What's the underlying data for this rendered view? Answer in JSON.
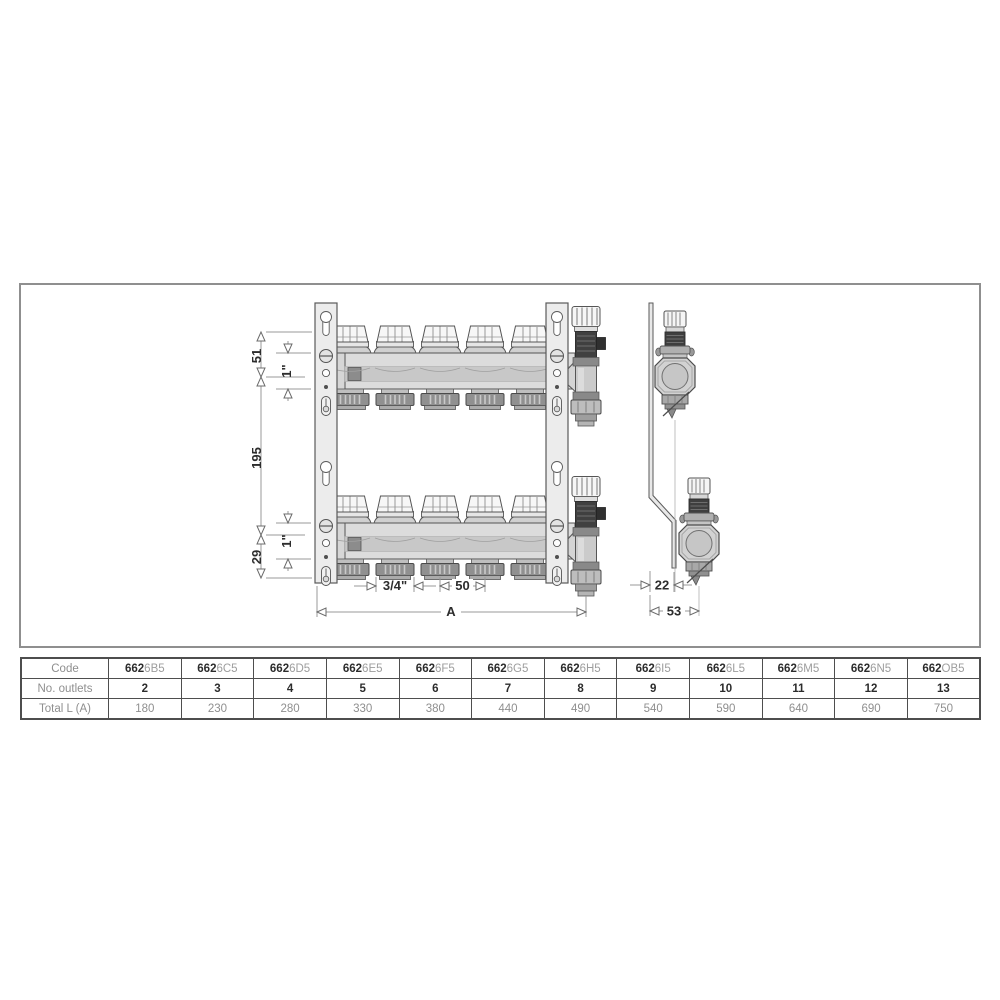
{
  "drawing": {
    "front": {
      "dim_top_offset": "51",
      "dim_pipe_top": "1\"",
      "dim_axis_distance": "195",
      "dim_bottom_offset": "29",
      "dim_pipe_bottom": "1\"",
      "dim_outlet_size": "3/4\"",
      "dim_outlet_spacing": "50",
      "dim_total_length": "A"
    },
    "side": {
      "dim_bracket_offset": "22",
      "dim_overall_depth": "53"
    }
  },
  "table": {
    "row_labels": {
      "code": "Code",
      "outlets": "No. outlets",
      "total": "Total L (A)"
    },
    "code_prefix": "662",
    "columns": [
      {
        "code_suffix": "6B5",
        "outlets": "2",
        "total": "180"
      },
      {
        "code_suffix": "6C5",
        "outlets": "3",
        "total": "230"
      },
      {
        "code_suffix": "6D5",
        "outlets": "4",
        "total": "280"
      },
      {
        "code_suffix": "6E5",
        "outlets": "5",
        "total": "330"
      },
      {
        "code_suffix": "6F5",
        "outlets": "6",
        "total": "380"
      },
      {
        "code_suffix": "6G5",
        "outlets": "7",
        "total": "440"
      },
      {
        "code_suffix": "6H5",
        "outlets": "8",
        "total": "490"
      },
      {
        "code_suffix": "6I5",
        "outlets": "9",
        "total": "540"
      },
      {
        "code_suffix": "6L5",
        "outlets": "10",
        "total": "590"
      },
      {
        "code_suffix": "6M5",
        "outlets": "11",
        "total": "640"
      },
      {
        "code_suffix": "6N5",
        "outlets": "12",
        "total": "690"
      },
      {
        "code_suffix": "OB5",
        "outlets": "13",
        "total": "750"
      }
    ]
  },
  "colors": {
    "frame_border": "#8f8f8f",
    "table_border": "#4e4e4e",
    "line": "#555555",
    "metal_light": "#dcdcdc",
    "metal_dark": "#3f3f3f",
    "dim_text": "#2d2d2d",
    "muted_text": "#8f8f8f"
  }
}
